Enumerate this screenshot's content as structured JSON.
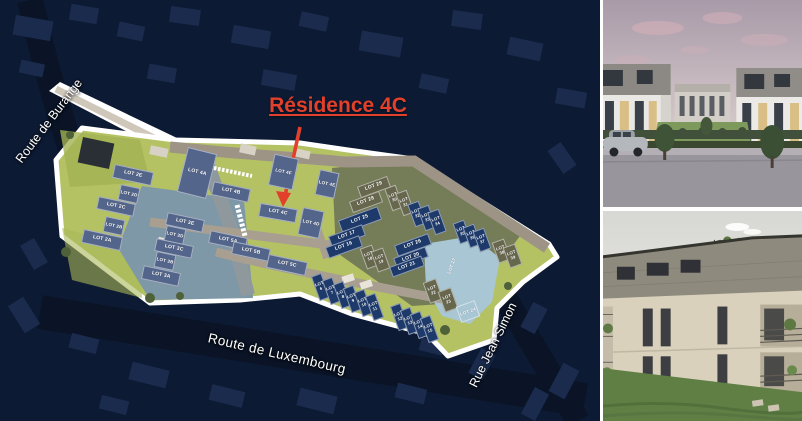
{
  "title": {
    "text": "Résidence 4C",
    "color": "#e2402b"
  },
  "plan": {
    "streets": {
      "burange": "Route de Burange",
      "luxembourg": "Route de Luxembourg",
      "jean_simon": "Rue Jean Simon"
    },
    "colors": {
      "slate": "#53658a",
      "olive": "#67674e",
      "navy": "#1d3a6b",
      "lightblue": "#a9c6d4",
      "site_green": "#b5c264",
      "teal": "#7e98a7",
      "cluster_olive": "#747c58",
      "road_tan": "#9d9486",
      "road_gray": "#8f999d",
      "outline_white": "#ffffff",
      "aerial_background": "#0d1a33",
      "accent_red": "#e2402b"
    },
    "lots": [
      {
        "label": "LOT 2E",
        "c": "slate",
        "x": 133,
        "y": 175,
        "w": 40,
        "h": 14,
        "r": 12,
        "fs": 5
      },
      {
        "label": "LOT 2D",
        "c": "slate",
        "x": 129,
        "y": 194,
        "w": 20,
        "h": 16,
        "r": 12,
        "fs": 4.5
      },
      {
        "label": "LOT 2C",
        "c": "slate",
        "x": 116,
        "y": 206,
        "w": 38,
        "h": 13,
        "r": 12,
        "fs": 5
      },
      {
        "label": "LOT 2B",
        "c": "slate",
        "x": 114,
        "y": 226,
        "w": 20,
        "h": 16,
        "r": 12,
        "fs": 4.5
      },
      {
        "label": "LOT 2A",
        "c": "slate",
        "x": 102,
        "y": 240,
        "w": 40,
        "h": 14,
        "r": 12,
        "fs": 5
      },
      {
        "label": "LOT 3E",
        "c": "slate",
        "x": 185,
        "y": 222,
        "w": 38,
        "h": 13,
        "r": 12,
        "fs": 5
      },
      {
        "label": "LOT 3D",
        "c": "slate",
        "x": 175,
        "y": 235,
        "w": 20,
        "h": 16,
        "r": 12,
        "fs": 4.5
      },
      {
        "label": "LOT 3C",
        "c": "slate",
        "x": 174,
        "y": 248,
        "w": 38,
        "h": 13,
        "r": 12,
        "fs": 5
      },
      {
        "label": "LOT 3B",
        "c": "slate",
        "x": 165,
        "y": 261,
        "w": 20,
        "h": 16,
        "r": 12,
        "fs": 4.5
      },
      {
        "label": "LOT 3A",
        "c": "slate",
        "x": 161,
        "y": 276,
        "w": 38,
        "h": 14,
        "r": 12,
        "fs": 5
      },
      {
        "label": "LOT 4A",
        "c": "slate",
        "x": 197,
        "y": 173,
        "w": 30,
        "h": 46,
        "r": 14,
        "fs": 5
      },
      {
        "label": "LOT 4B",
        "c": "slate",
        "x": 231,
        "y": 192,
        "w": 38,
        "h": 14,
        "r": 12,
        "fs": 5
      },
      {
        "label": "LOT 4F",
        "c": "slate",
        "x": 283,
        "y": 172,
        "w": 25,
        "h": 32,
        "r": 12,
        "fs": 4.5
      },
      {
        "label": "LOT 4E",
        "c": "slate",
        "x": 327,
        "y": 184,
        "w": 20,
        "h": 26,
        "r": 12,
        "fs": 4.5
      },
      {
        "label": "LOT 4C",
        "c": "slate",
        "x": 278,
        "y": 213,
        "w": 38,
        "h": 14,
        "r": 10,
        "fs": 5
      },
      {
        "label": "LOT 4D",
        "c": "slate",
        "x": 311,
        "y": 223,
        "w": 22,
        "h": 28,
        "r": 12,
        "fs": 4.5
      },
      {
        "label": "LOT 5A",
        "c": "slate",
        "x": 228,
        "y": 240,
        "w": 38,
        "h": 13,
        "r": 12,
        "fs": 5
      },
      {
        "label": "LOT 5B",
        "c": "slate",
        "x": 251,
        "y": 251,
        "w": 38,
        "h": 13,
        "r": 12,
        "fs": 5
      },
      {
        "label": "LOT 5C",
        "c": "slate",
        "x": 287,
        "y": 265,
        "w": 40,
        "h": 14,
        "r": 12,
        "fs": 5
      },
      {
        "label": "LOT 29",
        "c": "olive",
        "x": 374,
        "y": 187,
        "w": 32,
        "h": 12,
        "r": -20,
        "fs": 5
      },
      {
        "label": "LOT 28",
        "c": "olive",
        "x": 366,
        "y": 202,
        "w": 32,
        "h": 12,
        "r": -20,
        "fs": 5
      },
      {
        "label": "LOT 30",
        "c": "olive",
        "x": 394,
        "y": 198,
        "w": 12,
        "h": 24,
        "r": -20,
        "fs": 4.2
      },
      {
        "label": "LOT 31",
        "c": "olive",
        "x": 405,
        "y": 203,
        "w": 12,
        "h": 24,
        "r": -20,
        "fs": 4.2
      },
      {
        "label": "LOT 25",
        "c": "navy",
        "x": 360,
        "y": 220,
        "w": 42,
        "h": 14,
        "r": -20,
        "fs": 5
      },
      {
        "label": "LOT 32",
        "c": "navy",
        "x": 417,
        "y": 214,
        "w": 12,
        "h": 24,
        "r": -20,
        "fs": 4.2
      },
      {
        "label": "LOT 33",
        "c": "navy",
        "x": 427,
        "y": 218,
        "w": 12,
        "h": 24,
        "r": -20,
        "fs": 4.2
      },
      {
        "label": "LOT 34",
        "c": "navy",
        "x": 437,
        "y": 222,
        "w": 12,
        "h": 24,
        "r": -20,
        "fs": 4.2
      },
      {
        "label": "LOT 35",
        "c": "navy",
        "x": 462,
        "y": 232,
        "w": 12,
        "h": 22,
        "r": -20,
        "fs": 4.2
      },
      {
        "label": "LOT 36",
        "c": "navy",
        "x": 472,
        "y": 236,
        "w": 12,
        "h": 22,
        "r": -20,
        "fs": 4.2
      },
      {
        "label": "LOT 37",
        "c": "navy",
        "x": 482,
        "y": 240,
        "w": 12,
        "h": 22,
        "r": -20,
        "fs": 4.2
      },
      {
        "label": "LOT 38",
        "c": "olive",
        "x": 501,
        "y": 251,
        "w": 13,
        "h": 22,
        "r": -20,
        "fs": 4.2
      },
      {
        "label": "LOT 39",
        "c": "olive",
        "x": 512,
        "y": 256,
        "w": 13,
        "h": 22,
        "r": -20,
        "fs": 4.2
      },
      {
        "label": "LOT 17",
        "c": "navy",
        "x": 347,
        "y": 236,
        "w": 36,
        "h": 12,
        "r": -20,
        "fs": 5
      },
      {
        "label": "LOT 16",
        "c": "navy",
        "x": 344,
        "y": 247,
        "w": 36,
        "h": 12,
        "r": -20,
        "fs": 5
      },
      {
        "label": "LOT 18",
        "c": "olive",
        "x": 369,
        "y": 257,
        "w": 13,
        "h": 22,
        "r": -20,
        "fs": 4.2
      },
      {
        "label": "LOT 19",
        "c": "olive",
        "x": 380,
        "y": 260,
        "w": 13,
        "h": 22,
        "r": -20,
        "fs": 4.2
      },
      {
        "label": "LOT 26",
        "c": "navy",
        "x": 413,
        "y": 245,
        "w": 36,
        "h": 12,
        "r": -20,
        "fs": 5
      },
      {
        "label": "LOT 20",
        "c": "navy",
        "x": 411,
        "y": 257,
        "w": 34,
        "h": 11,
        "r": -20,
        "fs": 5
      },
      {
        "label": "LOT 21",
        "c": "navy",
        "x": 407,
        "y": 266,
        "w": 34,
        "h": 11,
        "r": -20,
        "fs": 5
      },
      {
        "label": "LOT 6",
        "c": "navy",
        "x": 320,
        "y": 287,
        "w": 11,
        "h": 26,
        "r": -20,
        "fs": 4.2
      },
      {
        "label": "LOT 7",
        "c": "navy",
        "x": 331,
        "y": 291,
        "w": 11,
        "h": 26,
        "r": -20,
        "fs": 4.2
      },
      {
        "label": "LOT 8",
        "c": "navy",
        "x": 342,
        "y": 295,
        "w": 11,
        "h": 26,
        "r": -20,
        "fs": 4.2
      },
      {
        "label": "LOT 9",
        "c": "navy",
        "x": 352,
        "y": 299,
        "w": 11,
        "h": 26,
        "r": -20,
        "fs": 4.2
      },
      {
        "label": "LOT 10",
        "c": "navy",
        "x": 363,
        "y": 303,
        "w": 11,
        "h": 26,
        "r": -20,
        "fs": 4.2
      },
      {
        "label": "LOT 11",
        "c": "navy",
        "x": 374,
        "y": 307,
        "w": 11,
        "h": 26,
        "r": -20,
        "fs": 4.2
      },
      {
        "label": "LOT 12",
        "c": "navy",
        "x": 399,
        "y": 317,
        "w": 11,
        "h": 26,
        "r": -20,
        "fs": 4.2
      },
      {
        "label": "LOT 13",
        "c": "navy",
        "x": 409,
        "y": 321,
        "w": 11,
        "h": 26,
        "r": -20,
        "fs": 4.2
      },
      {
        "label": "LOT 14",
        "c": "navy",
        "x": 419,
        "y": 325,
        "w": 11,
        "h": 26,
        "r": -20,
        "fs": 4.2
      },
      {
        "label": "LOT 15",
        "c": "navy",
        "x": 429,
        "y": 329,
        "w": 11,
        "h": 26,
        "r": -20,
        "fs": 4.2
      },
      {
        "label": "LOT 22",
        "c": "olive",
        "x": 433,
        "y": 291,
        "w": 14,
        "h": 22,
        "r": -20,
        "fs": 4.2
      },
      {
        "label": "LOT 23",
        "c": "olive",
        "x": 448,
        "y": 300,
        "w": 14,
        "h": 22,
        "r": -20,
        "fs": 4.2
      },
      {
        "label": "LOT 27",
        "c": "lightblue",
        "x": 452,
        "y": 266,
        "w": 18,
        "h": 28,
        "r": -70,
        "fs": 4.5,
        "bare": true
      },
      {
        "label": "LOT 24",
        "c": "lightblue",
        "x": 468,
        "y": 311,
        "w": 20,
        "h": 17,
        "r": -20,
        "fs": 4.5
      }
    ]
  }
}
